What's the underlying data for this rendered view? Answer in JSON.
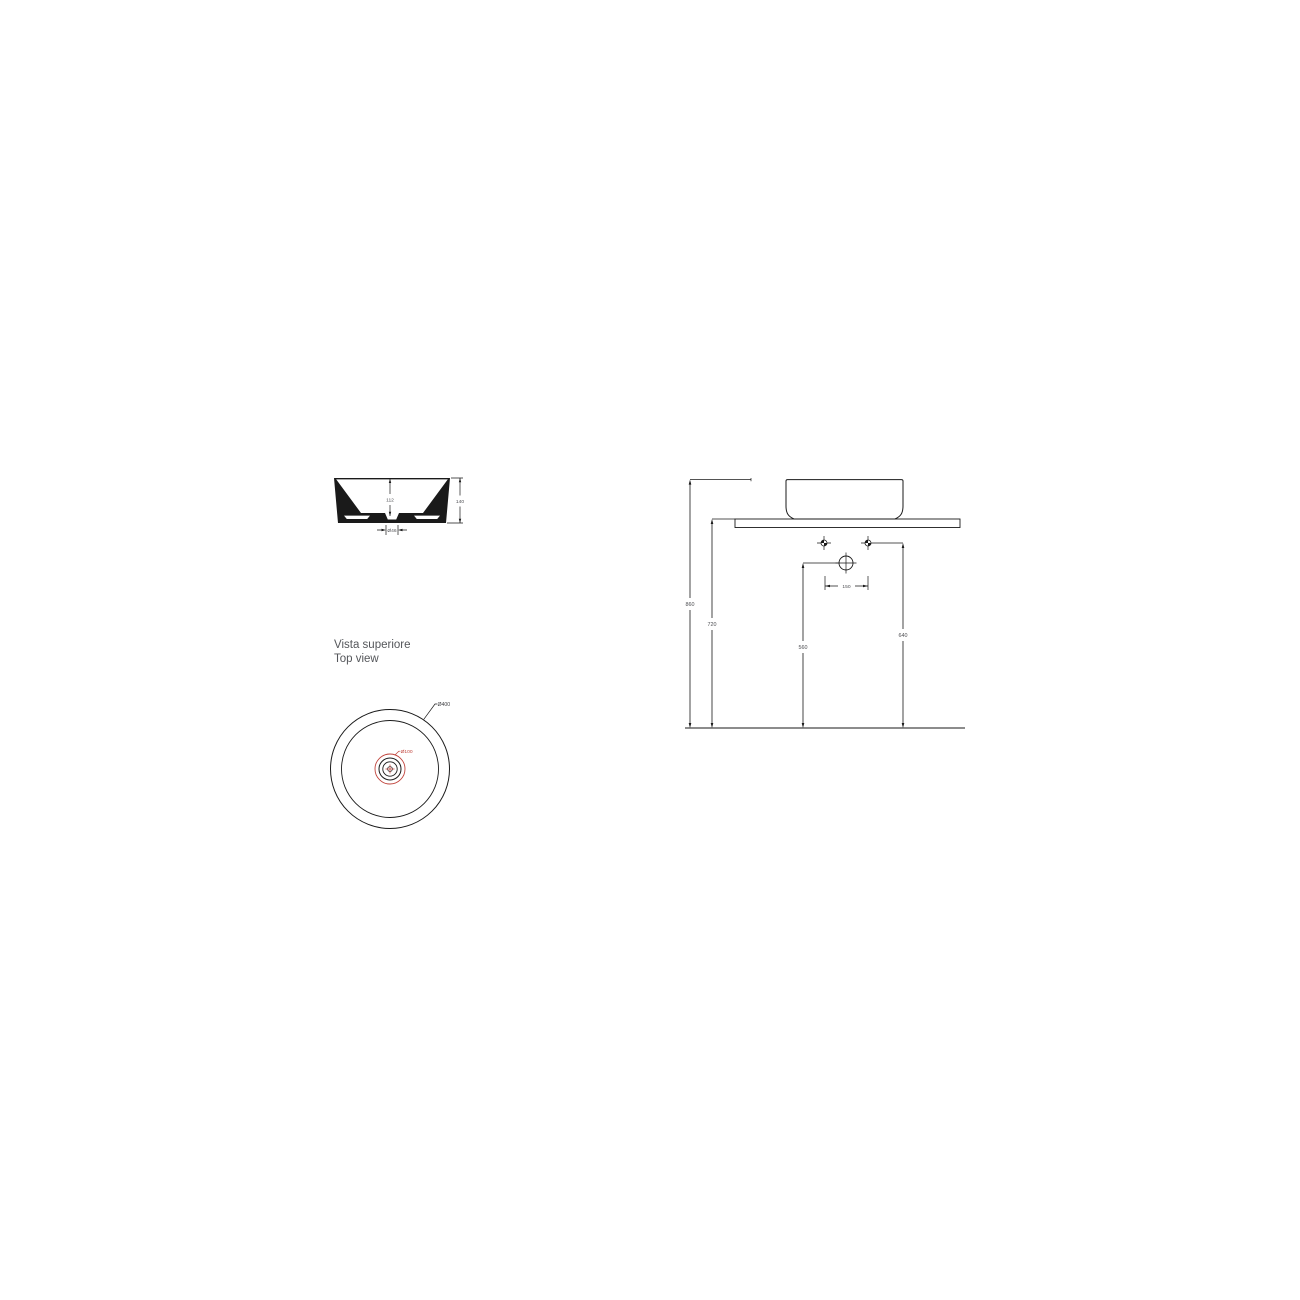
{
  "meta": {
    "view_title_it": "Vista superiore",
    "view_title_en": "Top view"
  },
  "colors": {
    "line": "#1a1a1a",
    "accent_red": "#c0443c",
    "label": "#4d4e52",
    "text": "#54565a"
  },
  "section_view": {
    "inner_depth": "112",
    "overall_height": "140",
    "drain_diameter": "Ø46"
  },
  "top_view": {
    "outer_diameter": "Ø400",
    "drain_diameter": "Ø100"
  },
  "installation_view": {
    "rim_height": "860",
    "counter_height": "720",
    "drain_height": "560",
    "supply_height": "640",
    "tap_spacing": "150"
  }
}
